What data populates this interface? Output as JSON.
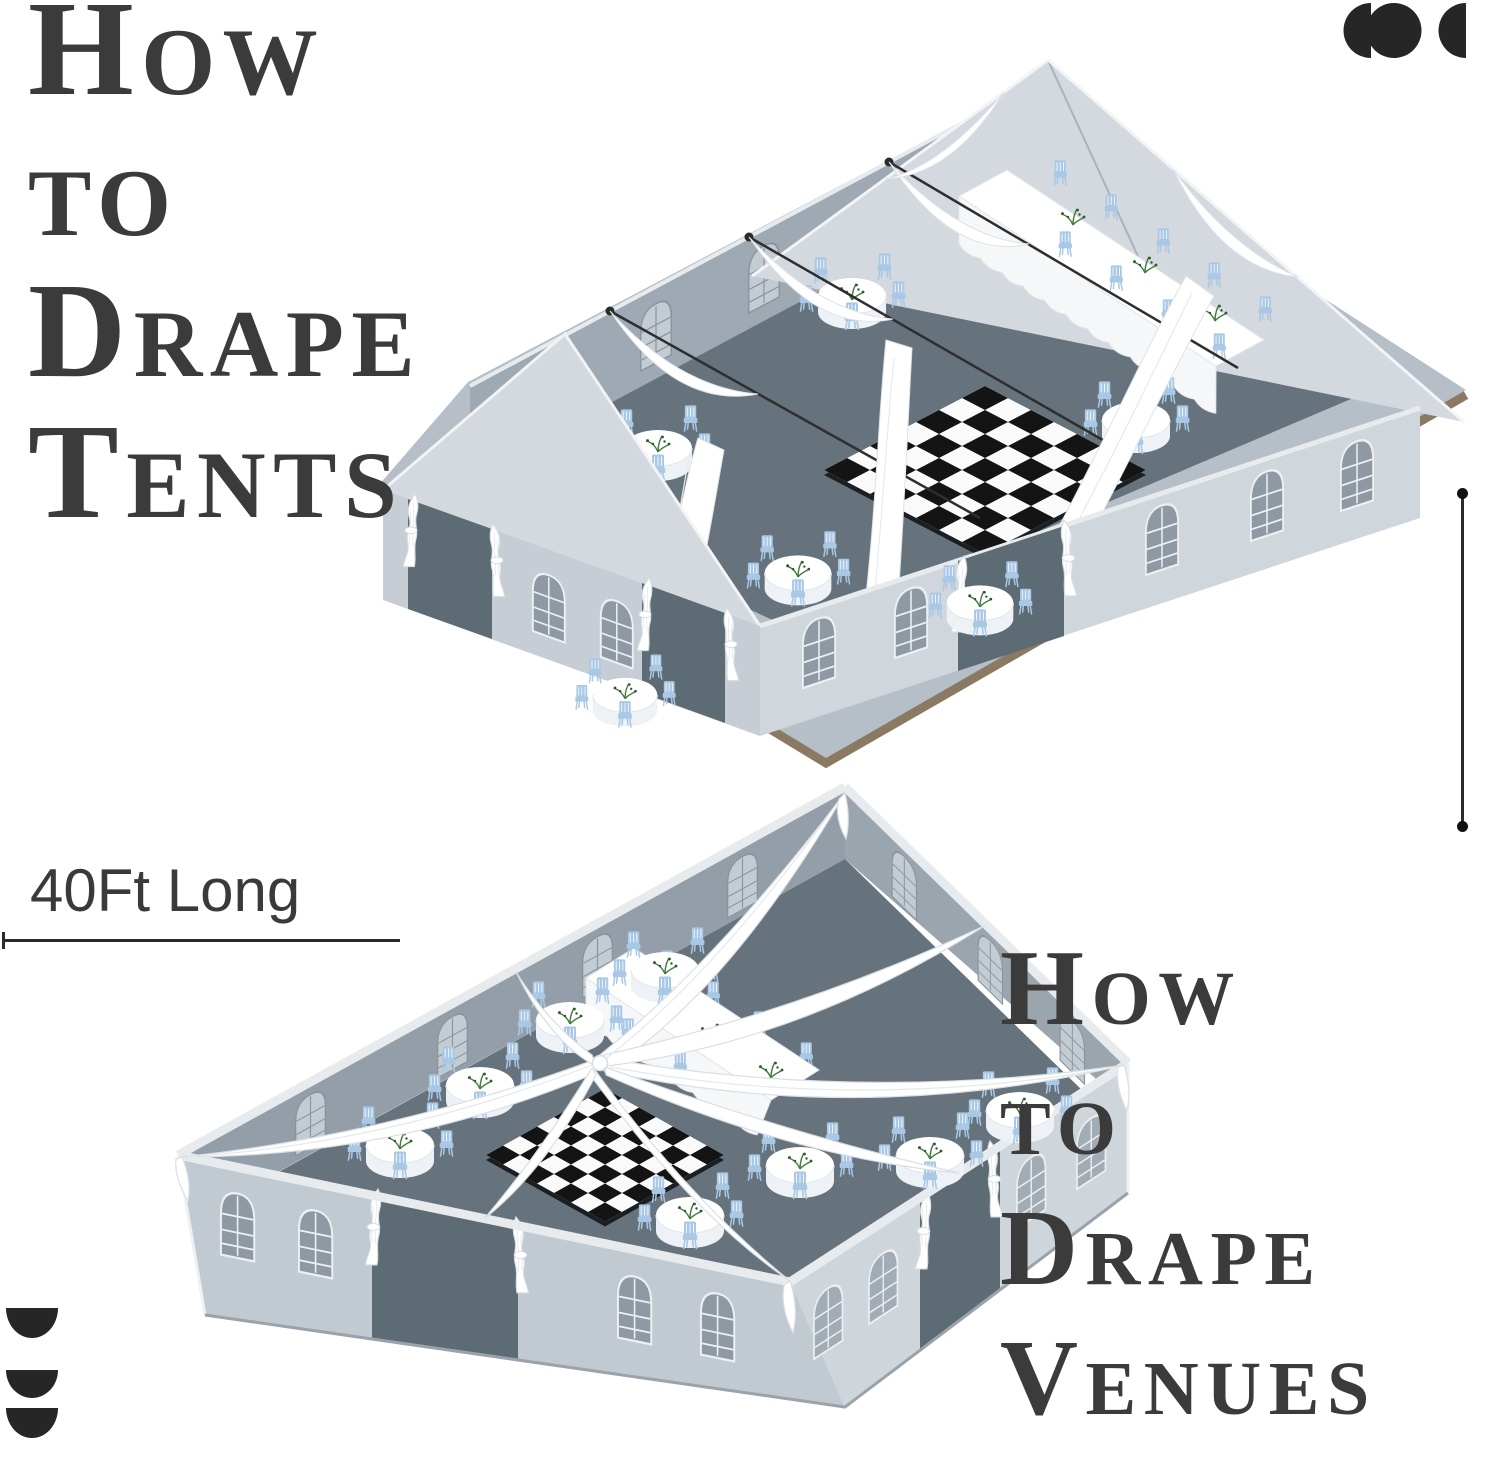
{
  "canvas": {
    "width": 1500,
    "height": 1469,
    "background": "#ffffff"
  },
  "titles": {
    "top": {
      "lines": [
        "How",
        "to",
        "Drape",
        "Tents"
      ],
      "color": "#3b3b3b"
    },
    "bottom": {
      "lines": [
        "How",
        "to",
        "Drape",
        "Venues"
      ],
      "color": "#3b3b3b"
    }
  },
  "annotations": {
    "length_label": "40Ft Long"
  },
  "brand": {
    "color": "#262626",
    "logo": "three-circle-crescent-logo",
    "footer_mark": "three-half-disc-mark"
  },
  "icons": {
    "top_right": "brand-logo-icon",
    "bottom_left": "steps-icon"
  },
  "illustrations": {
    "top_tent": "clear-top-tent-with-swag-draping",
    "bottom_venue": "open-venue-with-radial-star-draping"
  },
  "palette": {
    "title": "#3b3b3b",
    "dimension_line": "#2b2b2b",
    "floor": "#66737d",
    "wall_light": "#c9d0d7",
    "wall_lighter": "#d3d9de",
    "wall_interior": "#9ea9b3",
    "window_pane": "#8e99a3",
    "doorway": "#5d6b75",
    "chair": "#a9c8e5",
    "drape": "#ffffff",
    "checker_black": "#141414",
    "checker_white": "#fafafa",
    "platform": "#b6bfc7",
    "platform_edge": "#8a7a64",
    "greenery": "#3f7a3b"
  }
}
